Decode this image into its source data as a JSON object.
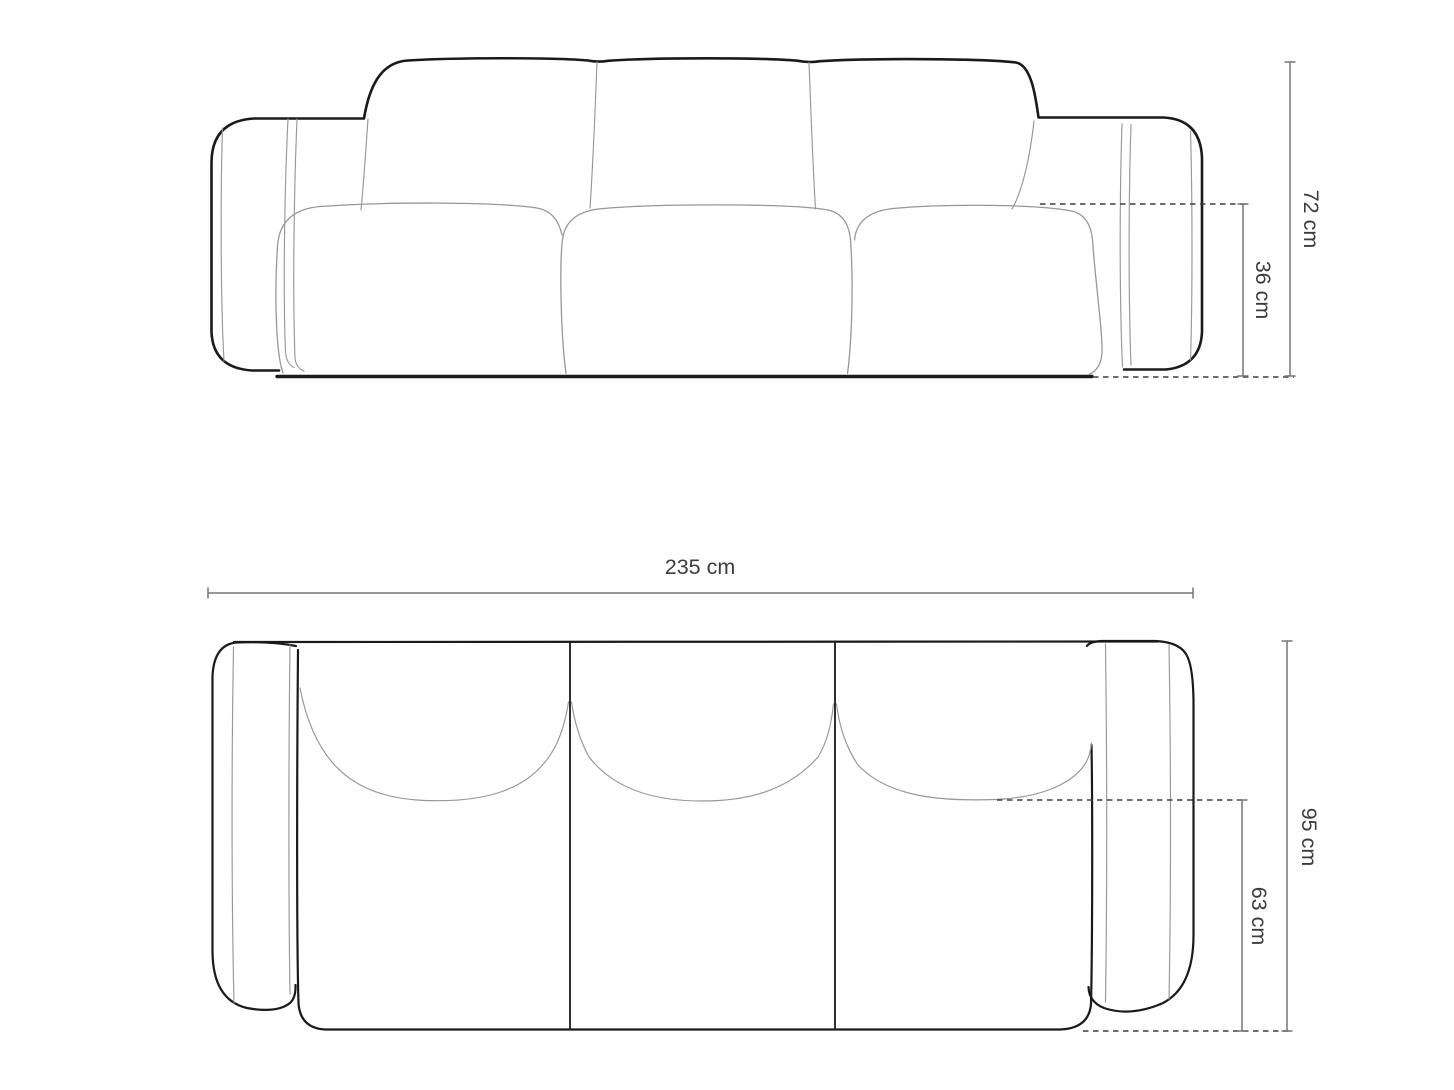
{
  "colors": {
    "outline": "#1a1a1a",
    "seam": "#979797",
    "dimension": "#757575",
    "dashed": "#3f3f3f",
    "text": "#3c3c3c",
    "background": "#ffffff"
  },
  "front_view": {
    "height_label": "72 cm",
    "seat_height_label": "36 cm"
  },
  "top_view": {
    "width_label": "235 cm",
    "depth_label": "95 cm",
    "seat_depth_label": "63 cm"
  }
}
